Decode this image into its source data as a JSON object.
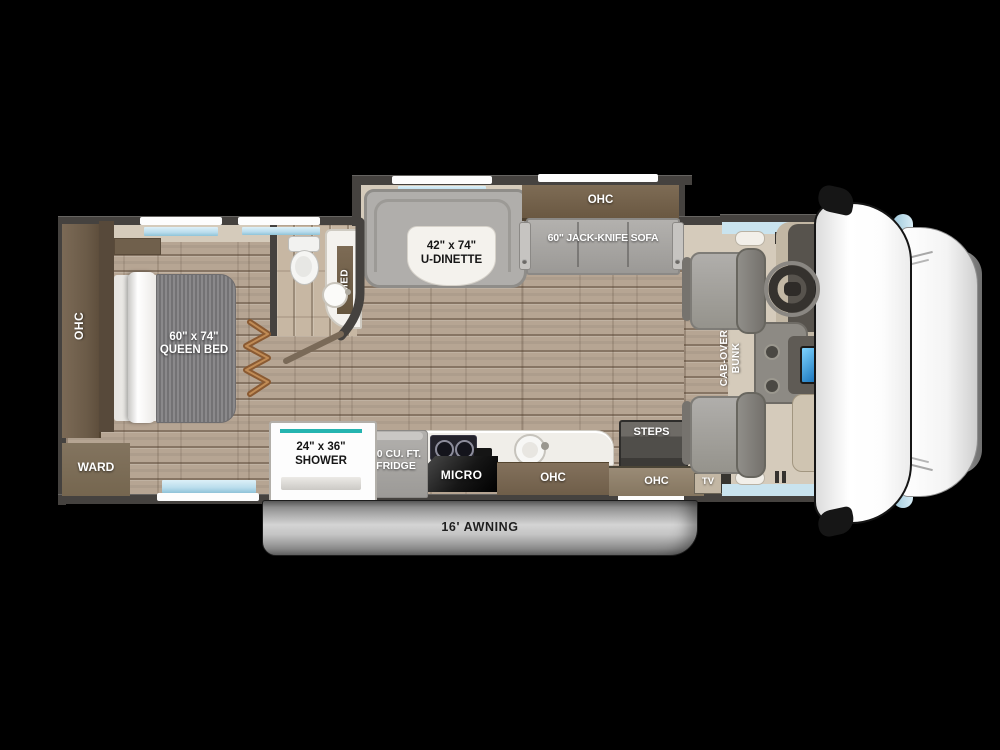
{
  "floorplan": {
    "bedroom": {
      "ohc_label": "OHC",
      "bed_size_label": "60\" x 74\"",
      "bed_name_label": "QUEEN BED",
      "ward_label": "WARD"
    },
    "bathroom": {
      "med_label": "MED"
    },
    "shower": {
      "size_label": "24\" x 36\"",
      "name_label": "SHOWER"
    },
    "dinette": {
      "size_label": "42\" x 74\"",
      "name_label": "U-DINETTE",
      "ohc_label": "OHC"
    },
    "sofa": {
      "label": "60\" JACK-KNIFE SOFA"
    },
    "kitchen": {
      "fridge_line1": "10 CU. FT.",
      "fridge_line2": "FRIDGE",
      "micro_label": "MICRO",
      "ohc_label": "OHC"
    },
    "entry": {
      "steps_label": "STEPS",
      "ohc_label": "OHC",
      "tv_label": "TV"
    },
    "cab": {
      "bunk_line1": "CAB-OVER",
      "bunk_line2": "BUNK"
    },
    "exterior": {
      "awning_label": "16' AWNING"
    }
  },
  "colors": {
    "background": "#000000",
    "wall": "#45423f",
    "wood_floor": "#b6a593",
    "cabinet_wood": "#6e5e4a",
    "window_glass": "#bcdeee",
    "shower_accent_teal": "#25b4b0",
    "mattress_gray": "#807f81",
    "sofa_gray": "#a9a7a4",
    "awning_gray": "#c6c6c6",
    "console_screen_blue": "#2f9ce0",
    "cab_body_white": "#ffffff"
  }
}
